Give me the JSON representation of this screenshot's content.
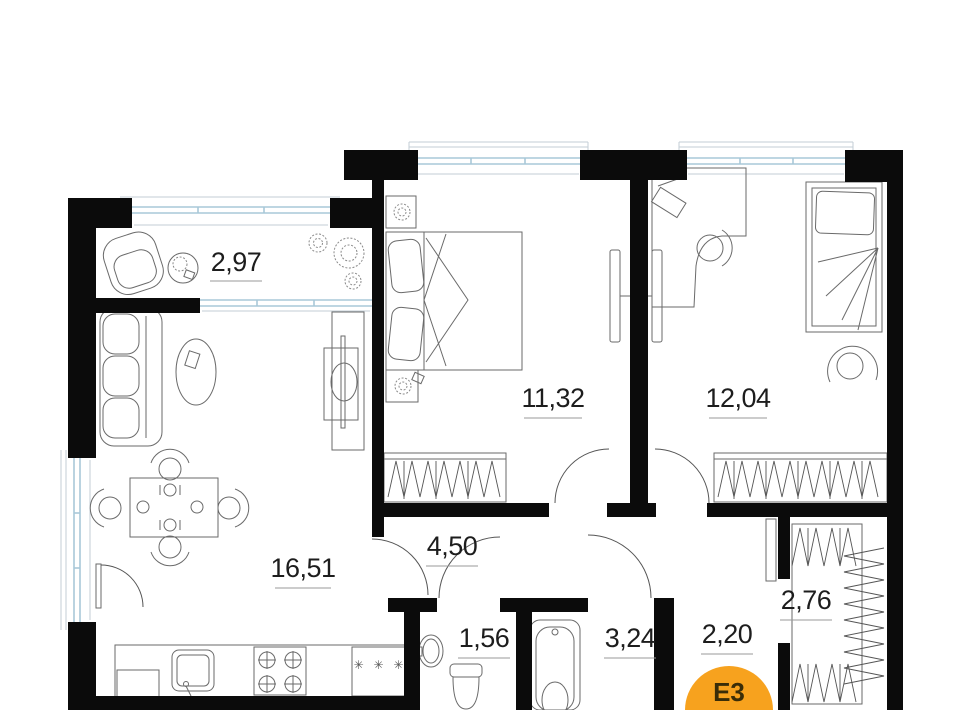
{
  "plan": {
    "unit_badge": {
      "label": "Е3",
      "color": "#F7A21E",
      "text_color": "#3a2d08"
    },
    "rooms": [
      {
        "name": "balcony",
        "area": "2,97"
      },
      {
        "name": "living-kitchen",
        "area": "16,51"
      },
      {
        "name": "bedroom-1",
        "area": "11,32"
      },
      {
        "name": "bedroom-2",
        "area": "12,04"
      },
      {
        "name": "corridor",
        "area": "4,50"
      },
      {
        "name": "wc",
        "area": "1,56"
      },
      {
        "name": "bathroom",
        "area": "3,24"
      },
      {
        "name": "entry-hall",
        "area": "2,20"
      },
      {
        "name": "wardrobe",
        "area": "2,76"
      }
    ],
    "kitchen": {
      "freezer_marks": "✳ ✳ ✳"
    },
    "colors": {
      "wall": "#0b0b0b",
      "window_frame": "#a8c8d8",
      "window_sill": "#c3ced6",
      "furniture_line": "#6a6a6a",
      "label_text": "#1d1d1d",
      "underline": "#9a9a9a",
      "badge": "#F7A21E",
      "badge_text": "#3a2d08"
    }
  }
}
